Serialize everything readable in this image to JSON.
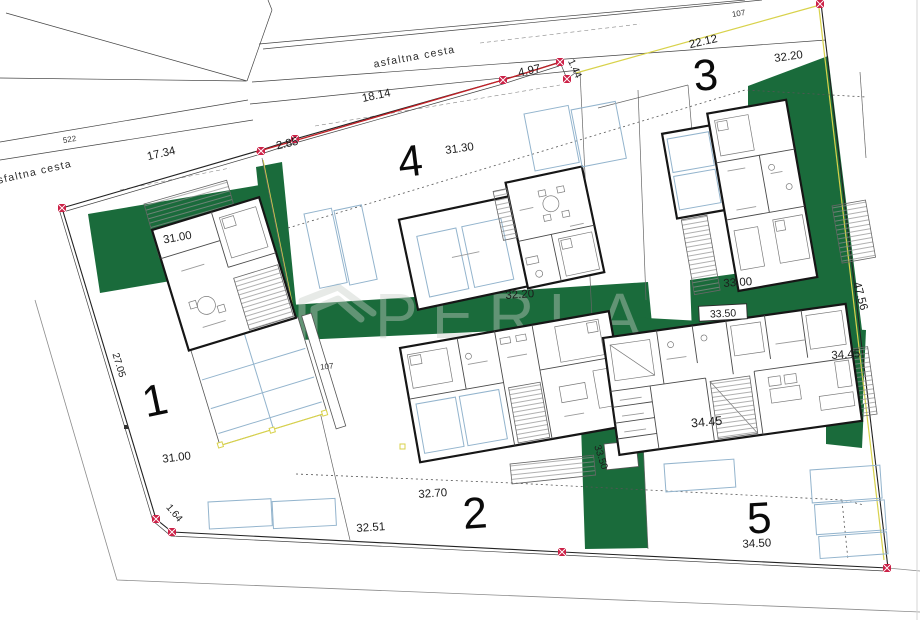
{
  "watermark": {
    "brand": "PERLA",
    "subtitle": "NEKRETNINE"
  },
  "roads": {
    "top": "asfaltna cesta",
    "left": "asfaltna cesta"
  },
  "parcels": {
    "ref_522": "522",
    "ref_107_top": "107",
    "ref_107_mid": "107"
  },
  "plot_numbers": {
    "p1": "1",
    "p2": "2",
    "p3": "3",
    "p4": "4",
    "p5": "5"
  },
  "dimensions": {
    "d17_34": "17.34",
    "d2_85": "2.85",
    "d18_14": "18.14",
    "d4_97": "4.97",
    "d1_44": "1.44",
    "d22_12": "22.12",
    "d32_20_ne": "32.20",
    "d31_30": "31.30",
    "d31_00_n": "31.00",
    "d27_05": "27.05",
    "d31_00_s": "31.00",
    "d1_64": "1.64",
    "d32_51": "32.51",
    "d32_70": "32.70",
    "d32_20_c": "32.20",
    "d33_00": "33.00",
    "d33_50_box": "33.50",
    "d33_50_w": "33.50",
    "d47_56": "47.56",
    "d34_45_e": "34.45",
    "d34_45_in": "34.45",
    "d34_50": "34.50"
  },
  "colors": {
    "green": "#1a6b3b",
    "boundary_red": "#c22026",
    "marker_red": "#cc2147",
    "parcel_blue": "#93b4cd",
    "accent_yellow": "#d8d24b",
    "watermark": "rgba(198,205,198,0.42)"
  }
}
